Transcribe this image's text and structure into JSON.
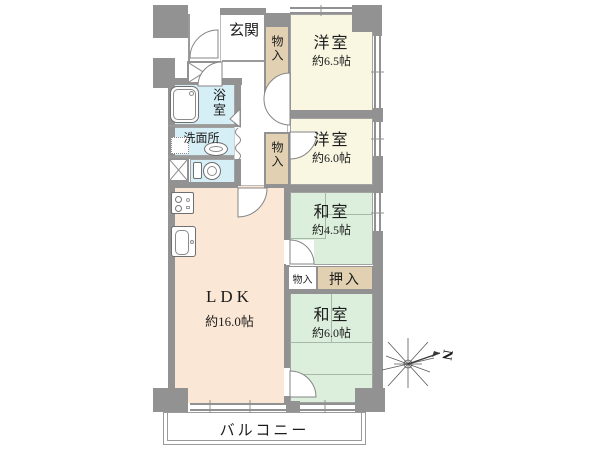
{
  "type": "floor_plan",
  "colors": {
    "wall": "#929292",
    "western_room": "#f9f6e2",
    "japanese_room": "#dcefdc",
    "ldk": "#fbe7d6",
    "wet_area": "#d6eef6",
    "closet": "#e1d1b2",
    "white": "#ffffff"
  },
  "rooms": {
    "genkan": {
      "label": "玄関"
    },
    "closet_top": {
      "label": "物入"
    },
    "western_65": {
      "label": "洋室",
      "area": "約6.5帖"
    },
    "western_60": {
      "label": "洋室",
      "area": "約6.0帖"
    },
    "bath": {
      "label": "浴室"
    },
    "washroom": {
      "label": "洗面所"
    },
    "closet_mid": {
      "label": "物入"
    },
    "japanese_45": {
      "label": "和室",
      "area": "約4.5帖"
    },
    "closet_small": {
      "label": "物入"
    },
    "oshiire": {
      "label": "押入"
    },
    "ldk": {
      "label": "LDK",
      "area": "約16.0帖"
    },
    "japanese_60": {
      "label": "和室",
      "area": "約6.0帖"
    },
    "balcony": {
      "label": "バルコニー"
    }
  },
  "compass": {
    "north_label": "N"
  }
}
